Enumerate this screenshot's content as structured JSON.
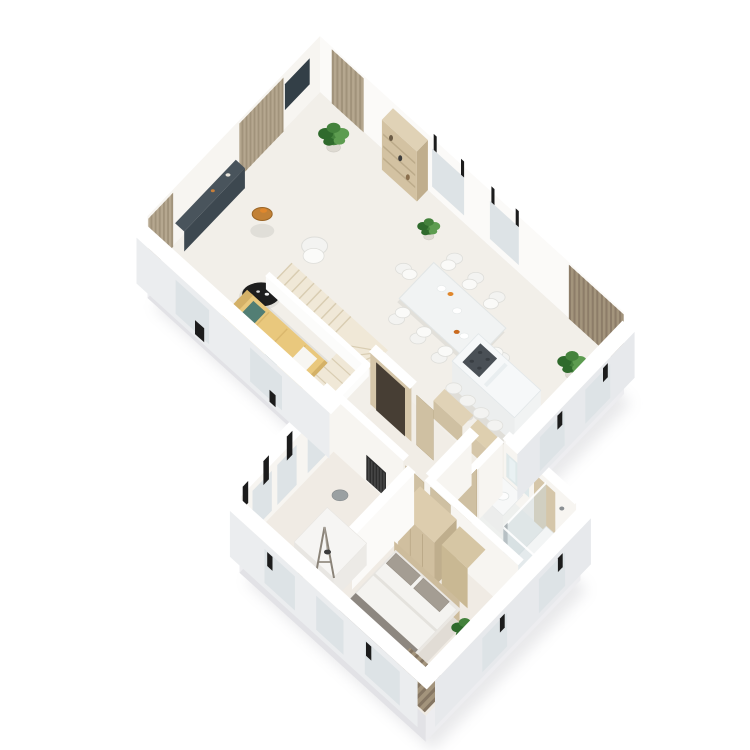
{
  "scene": {
    "label": "3D isometric floor plan rendering of a single-storey home interior with living-dining wing and bedroom wing",
    "view": "isometric-3d-cutaway",
    "background": "#ffffff"
  },
  "palette": {
    "background": "#ffffff",
    "floor": "#f2efe9",
    "floorLower": "#f0ebe4",
    "floorBath": "#eef0ee",
    "wallWhite": "#fbfaf8",
    "wallLight": "#f7f5f1",
    "wallCap": "#ffffff",
    "bandFace": "#ebedef",
    "bandFace2": "#e7e9ec",
    "plinthA": "#e2e2e6",
    "plinthB": "#ededf0",
    "shadow": "#cdced2",
    "curtainBase": "#b5a78f",
    "curtainDark": "#9b8c74",
    "curtainDim": "#a3947c",
    "curtainDimDark": "#857663",
    "tv": "#333f47",
    "media": "#3d4850",
    "mediaTop": "#49545c",
    "niche": "#473e34",
    "doorWood": "#cfc0a2",
    "woodSeam": "#b7a584",
    "beigeWall": "#d5c6a9",
    "shelf": "#d3c2a2",
    "shelfSide": "#c0ae8d",
    "shelfTop": "#e0d2b6",
    "wardrobe": "#d0bf9f",
    "sofa": "#e9c87d",
    "sofaDark": "#d4b167",
    "sofaLight": "#f1d78f",
    "teal": "#527e74",
    "tealDark": "#41695f",
    "stairTread": "#f0e8d7",
    "stairLine": "#d9cdb2",
    "parapet": "#fcfcfb",
    "table": "#f1f3f3",
    "chairFill": "#f3f3f1",
    "chairStroke": "#dededa",
    "islandTop": "#f6f8f9",
    "islandFace": "#eceeee",
    "islandSide": "#f1f3f3",
    "cooktop": "#4a5056",
    "burner": "#383d42",
    "stool": "#f3f3f1",
    "orange": "#e0872c",
    "black": "#1e1e1e",
    "gray": "#9aa0a2",
    "plantGreen": "#44823c",
    "plantGreenDark": "#2f6a2c",
    "plantGreenLight": "#5d9c50",
    "pot": "#dedad2",
    "bedFrame": "#eae7e2",
    "duvet": "#f4f3f0",
    "duvetFold": "#e4e2dd",
    "throw": "#8d8780",
    "pillow": "#a49d93",
    "headboard": "#cdbc9c",
    "deskSide": "#e8e6e2",
    "deskTop": "#f6f5f3",
    "easel": "#8a8378",
    "glass": "#cddade",
    "porcelain": "#f6f7f7",
    "porcelainStroke": "#e0e3e3",
    "mirror": "#dbe6e8",
    "radiatorDark": "#2d2d2d",
    "radiatorLine": "#4e4e4e",
    "windowSlit": "#dde3e6",
    "sash": "#1c1c1c",
    "sideTableTop": "#c28136"
  },
  "rooms": [
    {
      "id": "living-room",
      "label": "Living room",
      "furniture": [
        "tan sofa with teal pillows",
        "two round black coffee tables",
        "white armchair",
        "round side table with orange bowl",
        "dark media console wall",
        "wall TV panel",
        "striped curtains",
        "corner plant"
      ]
    },
    {
      "id": "dining-area",
      "label": "Dining area",
      "furniture": [
        "white dining table",
        "eight white chairs",
        "fruit bowls",
        "tall shelf unit",
        "plant"
      ]
    },
    {
      "id": "kitchen",
      "label": "Kitchen",
      "furniture": [
        "white island with dark cooktop",
        "four bar stools",
        "beige cabinets",
        "corner plant"
      ]
    },
    {
      "id": "staircase",
      "label": "Winder staircase",
      "furniture": [
        "cream treads",
        "white parapet"
      ]
    },
    {
      "id": "hallway",
      "label": "Hallway",
      "furniture": [
        "dark niche",
        "beige interior doors",
        "gray pouf"
      ]
    },
    {
      "id": "office",
      "label": "Study",
      "furniture": [
        "white desk",
        "easel with pendant lamp",
        "gray stool",
        "wall radiator",
        "window sashes"
      ]
    },
    {
      "id": "bedroom",
      "label": "Bedroom",
      "furniture": [
        "double bed with white duvet and gray pillows",
        "beige wardrobes",
        "plant",
        "dark striped curtain"
      ]
    },
    {
      "id": "bathroom",
      "label": "Bathroom",
      "furniture": [
        "glass shower",
        "vanity with basin",
        "mirror",
        "toilet"
      ]
    }
  ],
  "counts": {
    "dining_chairs": 8,
    "bar_stools": 4,
    "coffee_tables": 2,
    "plants": 5,
    "sections": 2
  }
}
